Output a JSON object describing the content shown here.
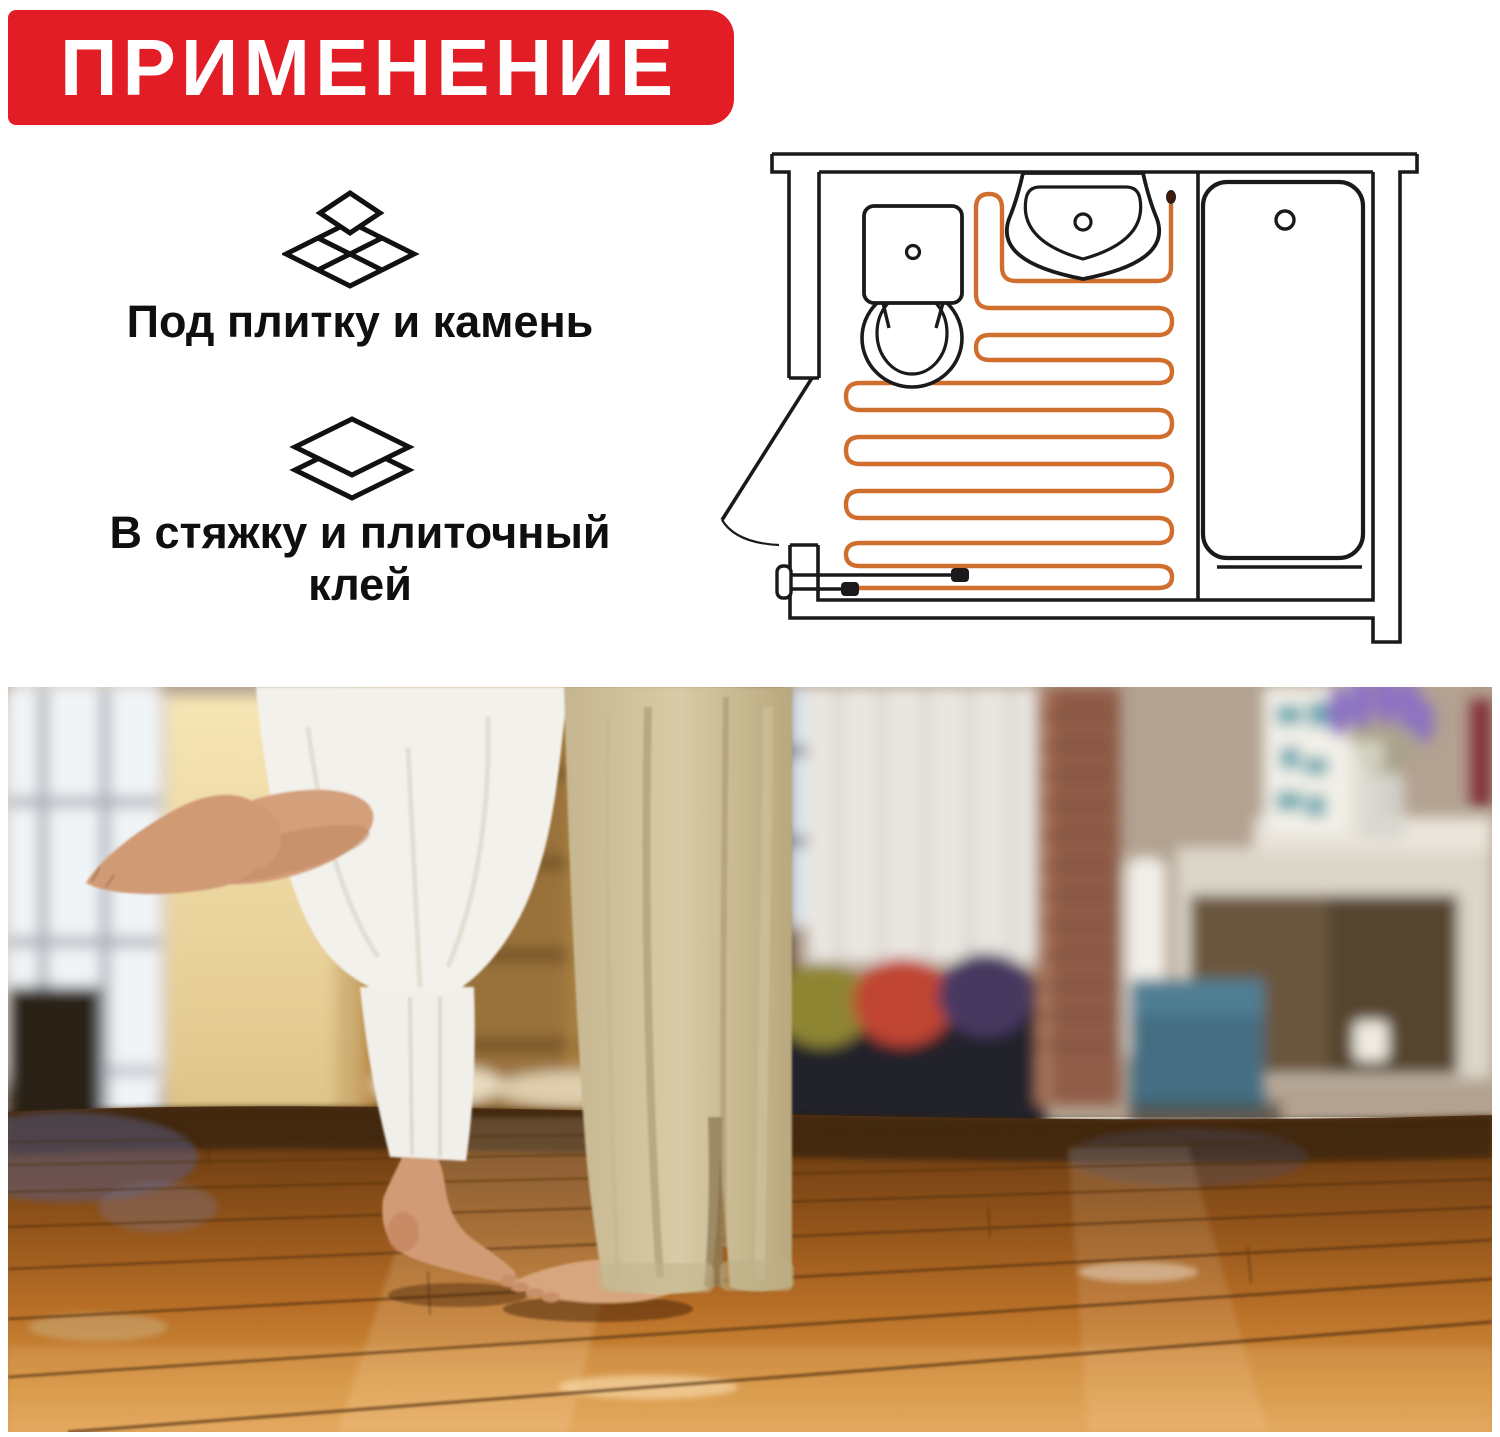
{
  "banner": {
    "label": "ПРИМЕНЕНИЕ",
    "bg_color": "#E21D26",
    "text_color": "#FFFFFF"
  },
  "features": [
    {
      "icon": "tiles-icon",
      "label": "Под плитку и камень"
    },
    {
      "icon": "layers-icon",
      "label": "В стяжку и плиточный клей"
    }
  ],
  "diagram": {
    "name": "bathroom-floor-plan-with-heating-cable",
    "line_color": "#1A1A1A",
    "cable_color": "#D06E2E",
    "fixtures": [
      "toilet",
      "sink",
      "bathtub",
      "door",
      "floor-sensor",
      "power-leads",
      "heating-cable-serpentine"
    ]
  },
  "photo": {
    "description": "couple barefoot on warm glossy wooden floor in living room",
    "floor_color": "#B86F27"
  }
}
